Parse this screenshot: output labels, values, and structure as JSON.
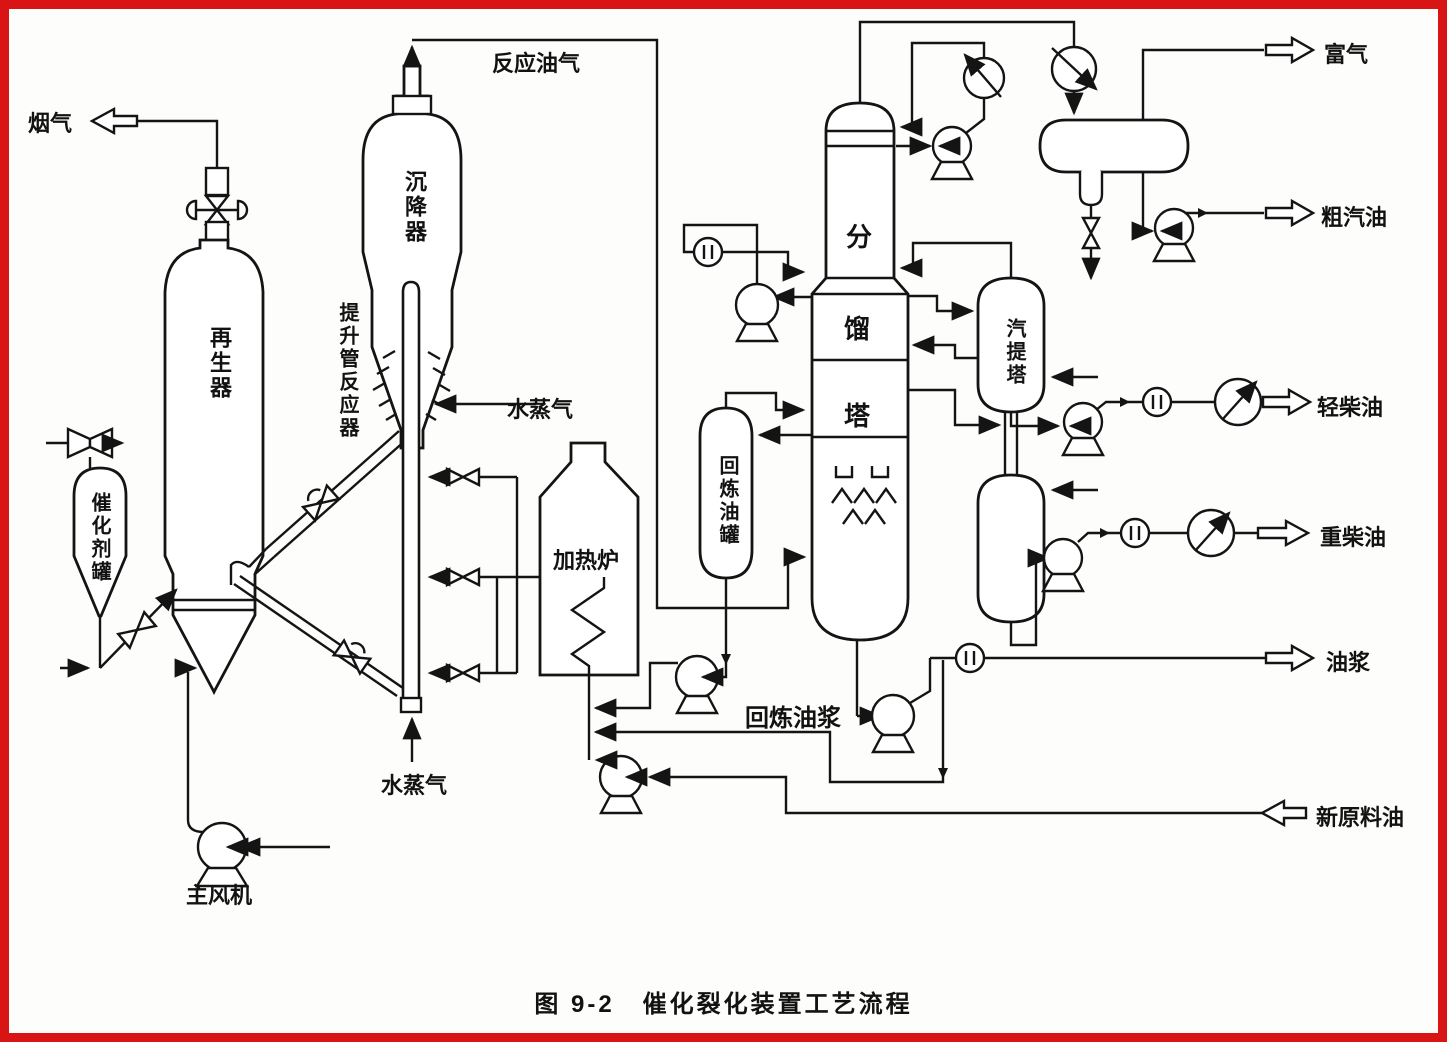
{
  "caption": {
    "prefix": "图 9-2",
    "title": "催化裂化装置工艺流程"
  },
  "colors": {
    "frame": "#d81414",
    "line": "#141414",
    "background": "#fdfdfb"
  },
  "equipment_labels": {
    "regenerator": "再生器",
    "settler": "沉降器",
    "riser_reactor": "提升管反应器",
    "catalyst_tank": "催化剂罐",
    "main_blower": "主风机",
    "heating_furnace": "加热炉",
    "recycle_oil_tank": "回炼油罐",
    "fractionator_char_top": "分",
    "fractionator_char_middle": "馏",
    "fractionator_char_bottom": "塔",
    "stripper": "汽提塔"
  },
  "stream_labels": {
    "flue_gas": "烟气",
    "reaction_oil_gas": "反应油气",
    "steam_top": "水蒸气",
    "steam_bottom": "水蒸气",
    "rich_gas": "富气",
    "crude_gasoline": "粗汽油",
    "light_diesel": "轻柴油",
    "heavy_diesel": "重柴油",
    "oil_slurry": "油浆",
    "recycle_slurry": "回炼油浆",
    "fresh_feed_oil": "新原料油"
  }
}
